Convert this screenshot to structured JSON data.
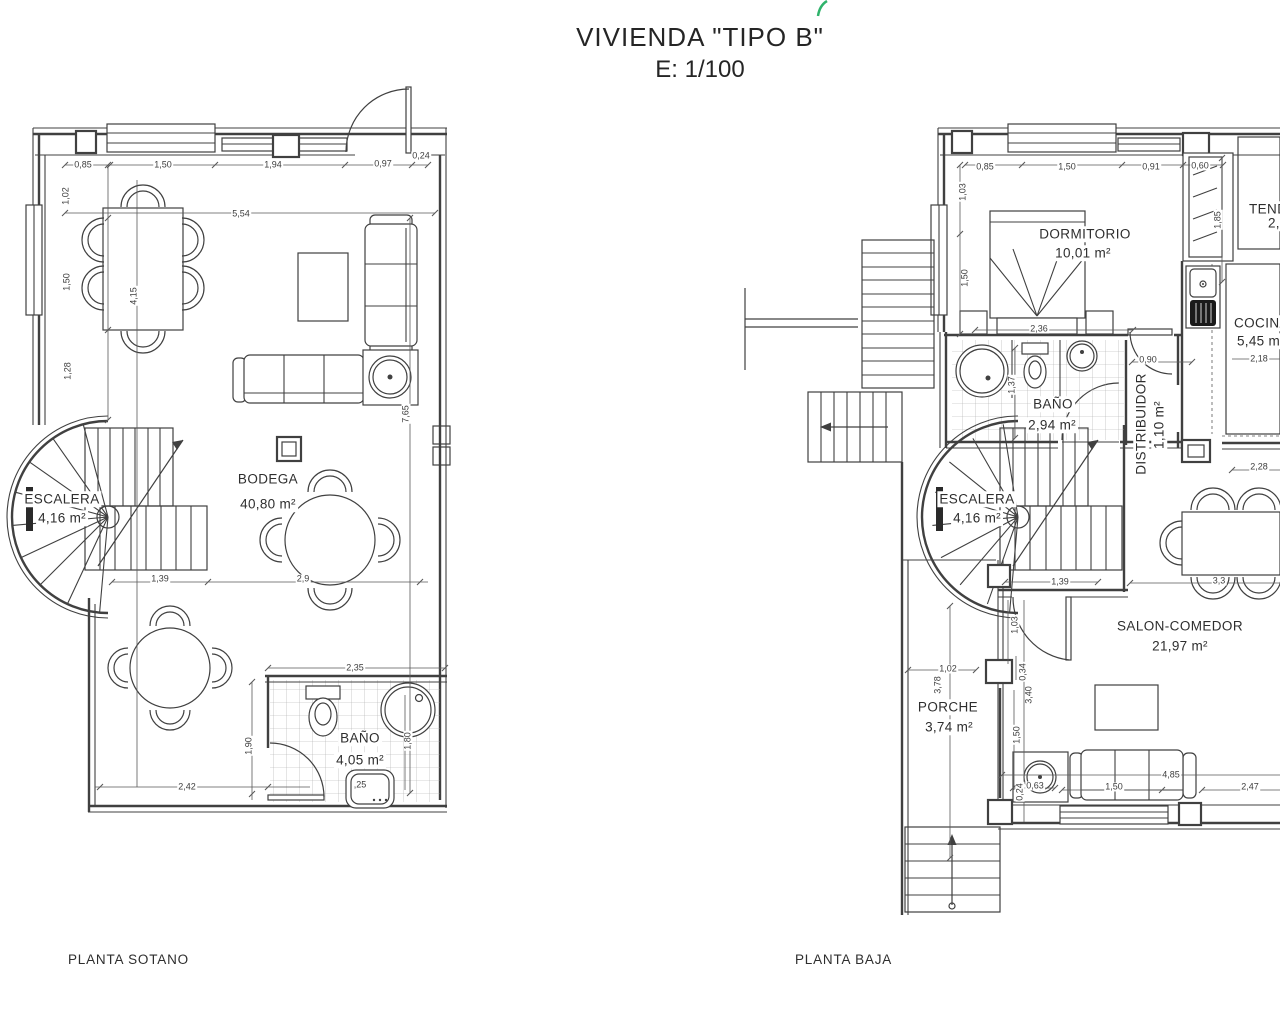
{
  "title": {
    "line1": "VIVIENDA \"TIPO B\"",
    "line2": "E: 1/100"
  },
  "accent_green": "#2fb36b",
  "line_color": "#404040",
  "plans": [
    {
      "id": "sotano",
      "caption": "PLANTA SOTANO",
      "capx": 68,
      "capy": 952,
      "rooms": [
        {
          "name": "ESCALERA",
          "area": "4,16 m²",
          "nx": 62,
          "ny": 499,
          "ax": 62,
          "ay": 518
        },
        {
          "name": "BODEGA",
          "area": "40,80 m²",
          "nx": 268,
          "ny": 479,
          "ax": 268,
          "ay": 504
        },
        {
          "name": "BAÑO",
          "area": "4,05 m²",
          "nx": 360,
          "ny": 738,
          "ax": 360,
          "ay": 760
        }
      ],
      "dims": [
        {
          "t": "0,85",
          "x": 83,
          "y": 165
        },
        {
          "t": "1,50",
          "x": 163,
          "y": 165
        },
        {
          "t": "1,94",
          "x": 273,
          "y": 165
        },
        {
          "t": "0,97",
          "x": 383,
          "y": 164
        },
        {
          "t": "0,24",
          "x": 421,
          "y": 156
        },
        {
          "t": "5,54",
          "x": 241,
          "y": 214
        },
        {
          "t": "1,02",
          "x": 66,
          "y": 196,
          "r": -90
        },
        {
          "t": "1,50",
          "x": 67,
          "y": 282,
          "r": -90
        },
        {
          "t": "1,28",
          "x": 68,
          "y": 371,
          "r": -90
        },
        {
          "t": "4,15",
          "x": 134,
          "y": 296,
          "r": -90
        },
        {
          "t": "7,65",
          "x": 406,
          "y": 414,
          "r": -90
        },
        {
          "t": "1,39",
          "x": 160,
          "y": 579
        },
        {
          "t": "2,9",
          "x": 303,
          "y": 579
        },
        {
          "t": "2,42",
          "x": 187,
          "y": 787
        },
        {
          "t": "2,35",
          "x": 355,
          "y": 668
        },
        {
          "t": "1,90",
          "x": 249,
          "y": 746,
          "r": -90
        },
        {
          "t": "1,80",
          "x": 408,
          "y": 741,
          "r": -90
        },
        {
          "t": ",25",
          "x": 360,
          "y": 785
        }
      ]
    },
    {
      "id": "baja",
      "caption": "PLANTA BAJA",
      "capx": 795,
      "capy": 952,
      "rooms": [
        {
          "name": "DORMITORIO",
          "area": "10,01 m²",
          "nx": 1085,
          "ny": 234,
          "ax": 1083,
          "ay": 253
        },
        {
          "name": "BAÑO",
          "area": "2,94 m²",
          "nx": 1053,
          "ny": 404,
          "ax": 1052,
          "ay": 425
        },
        {
          "name": "DISTRIBUIDOR",
          "area": "1,10 m²",
          "nx": 1141,
          "ny": 424,
          "ax": 1159,
          "ay": 425,
          "r": -90
        },
        {
          "name": "COCINA",
          "area": "5,45 m²",
          "nx": 1232,
          "ny": 323,
          "ax": 1235,
          "ay": 341,
          "align": "left"
        },
        {
          "name": "TENDEDERO",
          "area": "2,",
          "nx": 1247,
          "ny": 209,
          "ax": 1266,
          "ay": 223,
          "align": "left"
        },
        {
          "name": "ESCALERA",
          "area": "4,16 m²",
          "nx": 977,
          "ny": 499,
          "ax": 977,
          "ay": 518
        },
        {
          "name": "SALON-COMEDOR",
          "area": "21,97 m²",
          "nx": 1180,
          "ny": 626,
          "ax": 1180,
          "ay": 646
        },
        {
          "name": "PORCHE",
          "area": "3,74 m²",
          "nx": 948,
          "ny": 707,
          "ax": 949,
          "ay": 727
        }
      ],
      "dims": [
        {
          "t": "0,85",
          "x": 985,
          "y": 167
        },
        {
          "t": "1,50",
          "x": 1067,
          "y": 167
        },
        {
          "t": "0,91",
          "x": 1151,
          "y": 167
        },
        {
          "t": "0,60",
          "x": 1200,
          "y": 166
        },
        {
          "t": "1,03",
          "x": 963,
          "y": 192,
          "r": -90
        },
        {
          "t": "1,50",
          "x": 965,
          "y": 278,
          "r": -90
        },
        {
          "t": "1,85",
          "x": 1218,
          "y": 220,
          "r": -90
        },
        {
          "t": "2,36",
          "x": 1039,
          "y": 329
        },
        {
          "t": "0,90",
          "x": 1148,
          "y": 360
        },
        {
          "t": "1,37",
          "x": 1012,
          "y": 385,
          "r": -90
        },
        {
          "t": "2,18",
          "x": 1259,
          "y": 359
        },
        {
          "t": "2,28",
          "x": 1259,
          "y": 467
        },
        {
          "t": "3,3",
          "x": 1219,
          "y": 581
        },
        {
          "t": "1,39",
          "x": 1060,
          "y": 582
        },
        {
          "t": "1,03",
          "x": 1015,
          "y": 625,
          "r": -90
        },
        {
          "t": "0,34",
          "x": 1023,
          "y": 672,
          "r": -90
        },
        {
          "t": "3,40",
          "x": 1029,
          "y": 695,
          "r": -90
        },
        {
          "t": "1,50",
          "x": 1017,
          "y": 735,
          "r": -90
        },
        {
          "t": "1,02",
          "x": 948,
          "y": 669
        },
        {
          "t": "3,78",
          "x": 938,
          "y": 685,
          "r": -90
        },
        {
          "t": "4,85",
          "x": 1171,
          "y": 775
        },
        {
          "t": "1,50",
          "x": 1114,
          "y": 787
        },
        {
          "t": "2,47",
          "x": 1250,
          "y": 787
        },
        {
          "t": "0,63",
          "x": 1035,
          "y": 786
        },
        {
          "t": "0,24",
          "x": 1020,
          "y": 792,
          "r": -90
        }
      ]
    }
  ]
}
